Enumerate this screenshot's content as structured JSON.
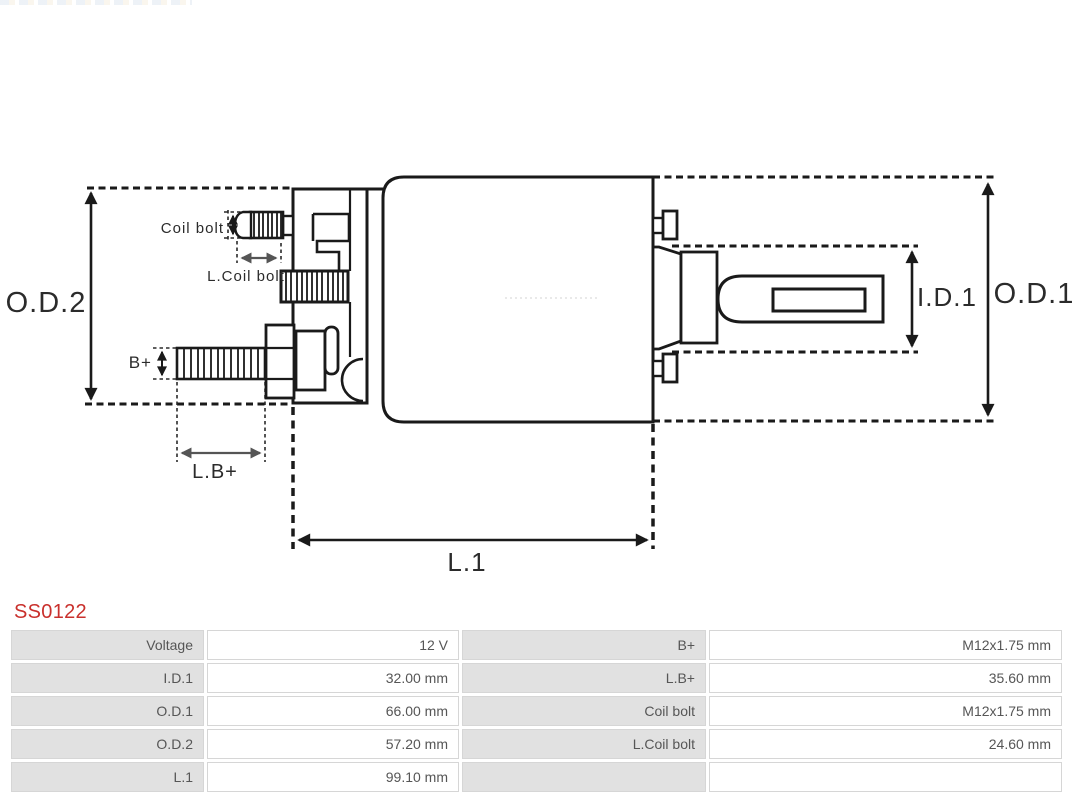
{
  "part_number": "SS0122",
  "diagram": {
    "labels": {
      "od2": "O.D.2",
      "od1": "O.D.1",
      "id1": "I.D.1",
      "l1": "L.1",
      "lb_plus": "L.B+",
      "b_plus": "B+",
      "coil_bolt": "Coil bolt",
      "l_coil_bolt": "L.Coil bolt"
    }
  },
  "spec_table": {
    "rows": [
      {
        "label1": "Voltage",
        "value1": "12 V",
        "label2": "B+",
        "value2": "M12x1.75 mm"
      },
      {
        "label1": "I.D.1",
        "value1": "32.00 mm",
        "label2": "L.B+",
        "value2": "35.60 mm"
      },
      {
        "label1": "O.D.1",
        "value1": "66.00 mm",
        "label2": "Coil bolt",
        "value2": "M12x1.75 mm"
      },
      {
        "label1": "O.D.2",
        "value1": "57.20 mm",
        "label2": "L.Coil bolt",
        "value2": "24.60 mm"
      },
      {
        "label1": "L.1",
        "value1": "99.10 mm",
        "label2": "",
        "value2": ""
      }
    ]
  },
  "colors": {
    "accent_red": "#c9302c",
    "line": "#1a1a1a",
    "dim_gray": "#555555",
    "table_label_bg": "#e1e1e1",
    "table_border": "#d6d6d6"
  }
}
